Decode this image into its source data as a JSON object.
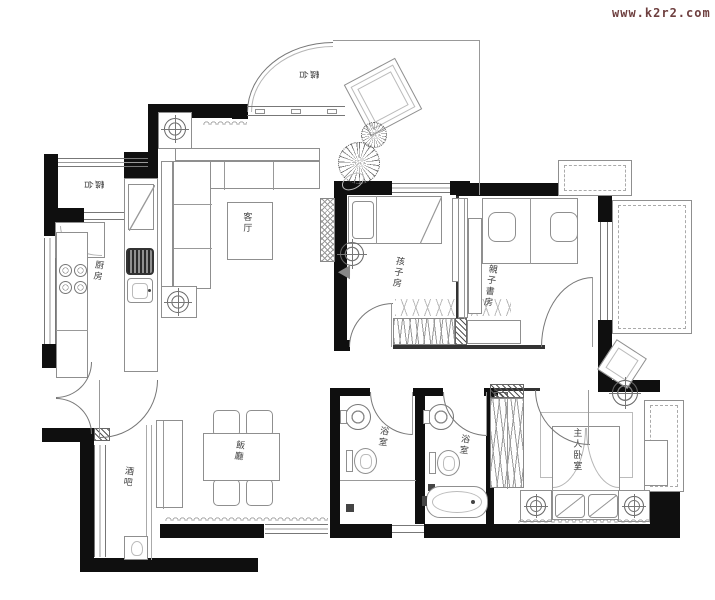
{
  "watermark": {
    "text": "www.k2r2.com",
    "color": "#6e3f3f"
  },
  "labels": {
    "balcony_top": "露台",
    "balcony_left": "露台",
    "kitchen": "厨房",
    "living_room": "客厅",
    "kids_room": "孩子房",
    "study_room": "親子書房",
    "master_bedroom": "主人卧室",
    "bathroom_left": "浴室",
    "bathroom_right": "浴室",
    "dining_room": "飯廳",
    "bar": "酒吧"
  },
  "colors": {
    "wall": "#0f0f0f",
    "thin_wall": "#333333",
    "furniture_line": "#8f8f8f",
    "label_text": "#3f3f3f",
    "background": "#ffffff"
  }
}
